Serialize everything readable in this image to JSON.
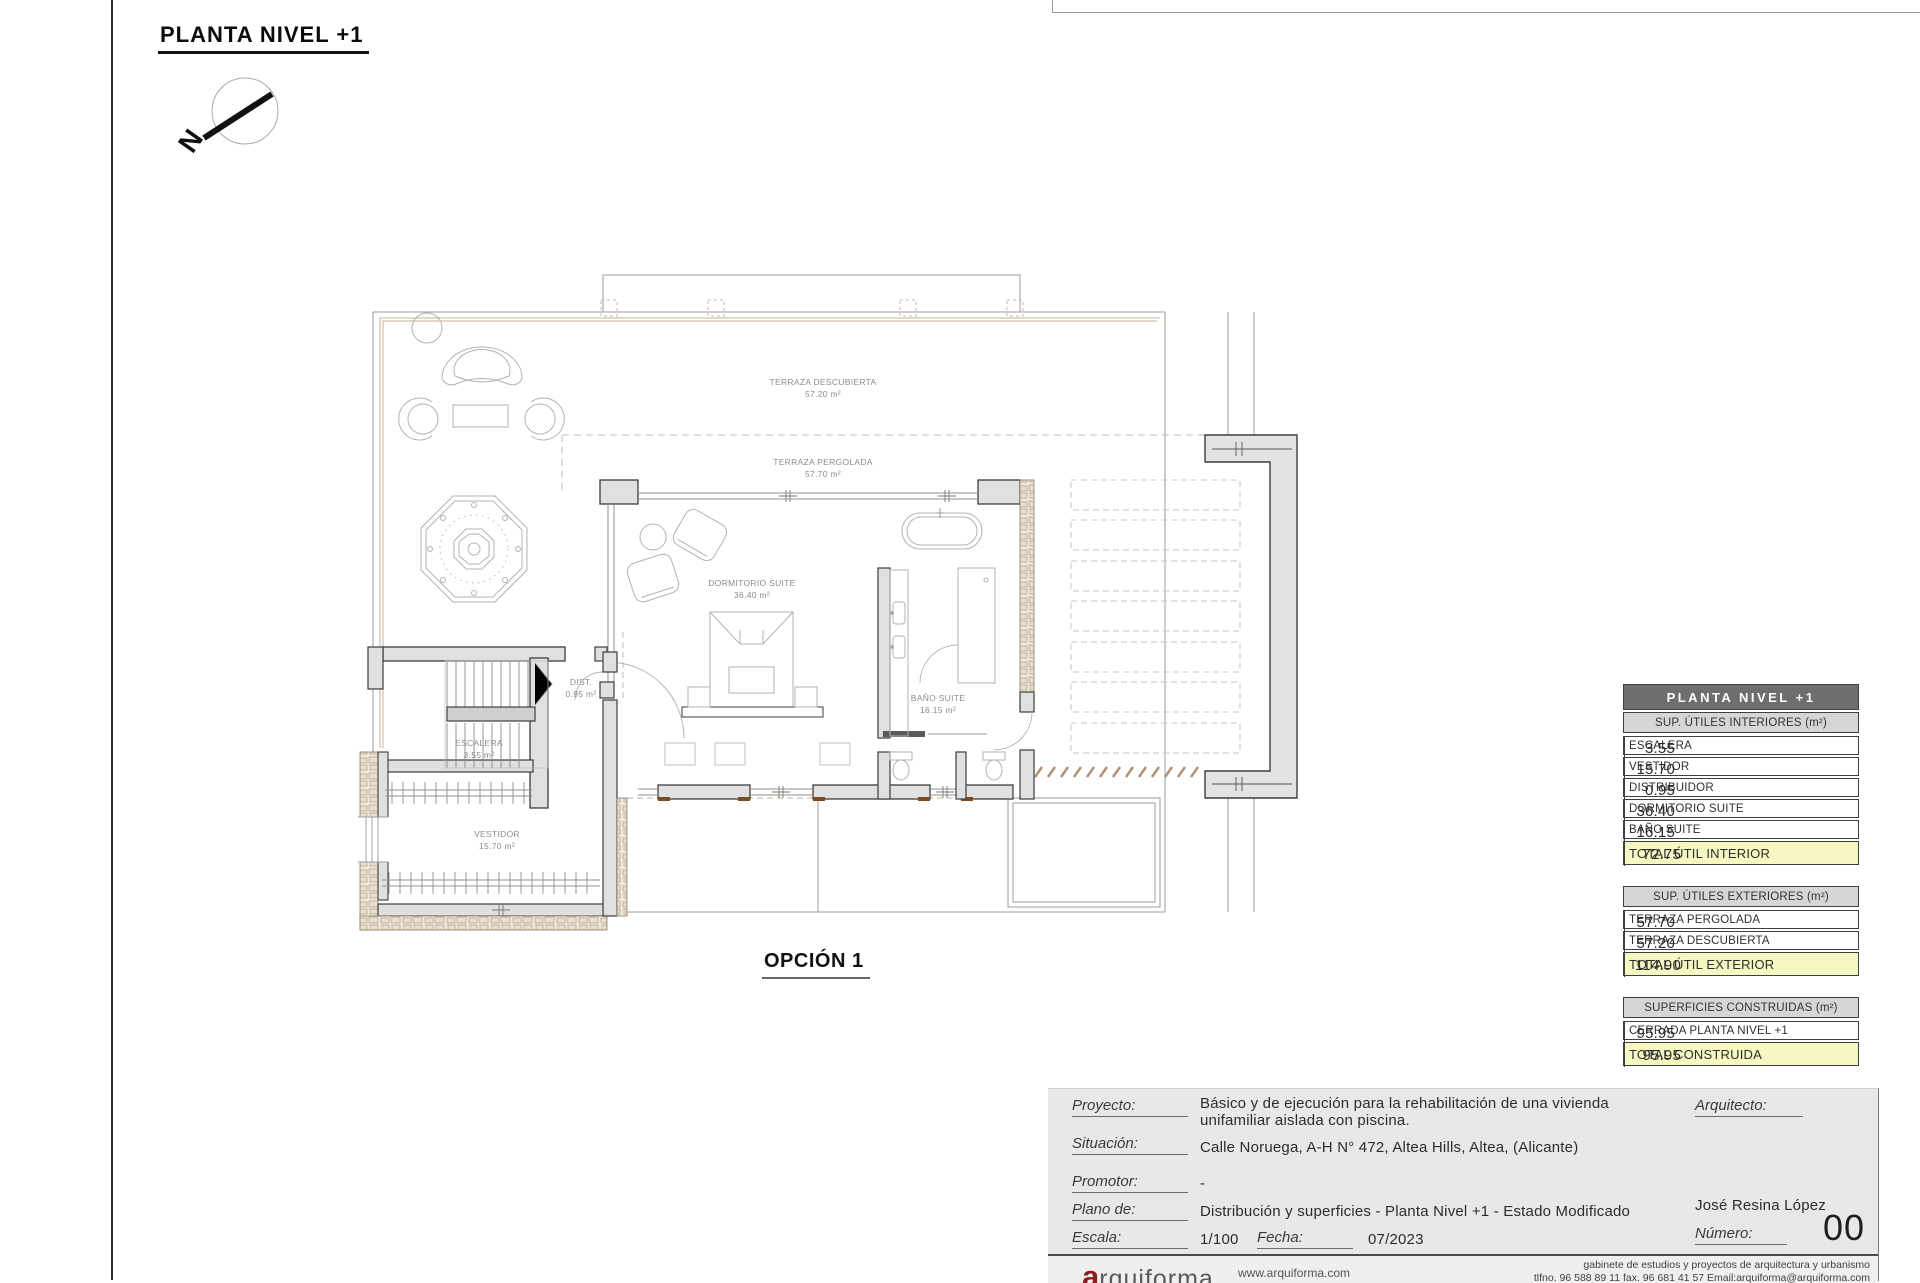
{
  "sheet": {
    "title": "PLANTA NIVEL +1",
    "option": "OPCIÓN 1",
    "north": "N"
  },
  "plan_labels": {
    "terraza_descubierta": {
      "name": "TERRAZA DESCUBIERTA",
      "area": "57.20 m²"
    },
    "terraza_pergolada": {
      "name": "TERRAZA PERGOLADA",
      "area": "57.70 m²"
    },
    "dormitorio_suite": {
      "name": "DORMITORIO SUITE",
      "area": "36.40 m²"
    },
    "bano_suite": {
      "name": "BAÑO SUITE",
      "area": "16.15 m²"
    },
    "dist": {
      "name": "DIST.",
      "area": "0.95 m²"
    },
    "escalera": {
      "name": "ESCALERA",
      "area": "3.55 m²"
    },
    "vestidor": {
      "name": "VESTIDOR",
      "area": "15.70 m²"
    }
  },
  "tables": [
    {
      "title": "PLANTA NIVEL +1",
      "subtitle": "SUP. ÚTILES INTERIORES (m²)",
      "rows": [
        {
          "label": "ESCALERA",
          "value": "3.55"
        },
        {
          "label": "VESTIDOR",
          "value": "15.70"
        },
        {
          "label": "DISTRIBUIDOR",
          "value": "0.95"
        },
        {
          "label": "DORMITORIO SUITE",
          "value": "36.40"
        },
        {
          "label": "BAÑO SUITE",
          "value": "16.15"
        }
      ],
      "total": {
        "label": "TOTAL ÚTIL INTERIOR",
        "value": "72.75"
      }
    },
    {
      "subtitle": "SUP. ÚTILES EXTERIORES (m²)",
      "rows": [
        {
          "label": "TERRAZA PERGOLADA",
          "value": "57.70"
        },
        {
          "label": "TERRAZA DESCUBIERTA",
          "value": "57.20"
        }
      ],
      "total": {
        "label": "TOTAL ÚTIL EXTERIOR",
        "value": "114.90"
      }
    },
    {
      "subtitle": "SUPERFICIES CONSTRUIDAS (m²)",
      "rows": [
        {
          "label": "CERRADA PLANTA NIVEL +1",
          "value": "95.95"
        }
      ],
      "total": {
        "label": "TOTAL CONSTRUIDA",
        "value": "95.95"
      }
    }
  ],
  "title_block": {
    "proyecto_label": "Proyecto:",
    "proyecto_line1": "Básico y de ejecución para la rehabilitación de una vivienda",
    "proyecto_line2": "unifamiliar aislada con piscina.",
    "situacion_label": "Situación:",
    "situacion_value": "Calle Noruega, A-H  N° 472, Altea Hills, Altea, (Alicante)",
    "promotor_label": "Promotor:",
    "promotor_value": "-",
    "plano_label": "Plano de:",
    "plano_value": "Distribución y superficies - Planta Nivel +1 - Estado Modificado",
    "escala_label": "Escala:",
    "escala_value": "1/100",
    "fecha_label": "Fecha:",
    "fecha_value": "07/2023",
    "arquitecto_label": "Arquitecto:",
    "arquitecto_name": "José Resina López",
    "numero_label": "Número:",
    "numero_value": "00"
  },
  "footer": {
    "logo_initial": "a",
    "logo_rest": "rquiforma",
    "website": "www.arquiforma.com",
    "line1": "gabinete de estudios y proyectos de arquitectura y urbanismo",
    "line2": "tlfno. 96 588 89 11  fax. 96 681 41 57  Email:arquiforma@arquiforma.com"
  }
}
